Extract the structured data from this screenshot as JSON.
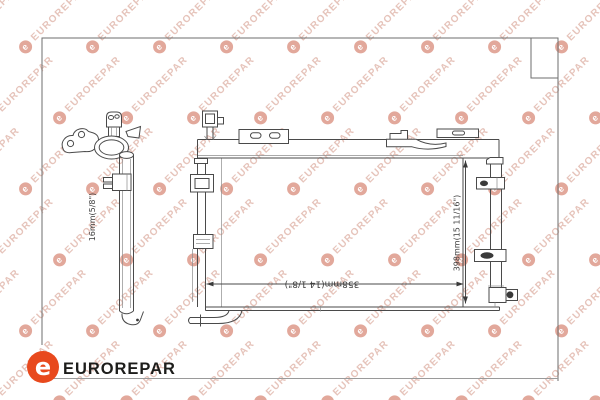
{
  "watermark": {
    "text": "EUROREPAR",
    "letter": "e",
    "text_color": "#e6c4bb",
    "circle_color": "#e2a89b",
    "letter_color": "#ffffff"
  },
  "footer": {
    "brand_text": "EUROREPAR",
    "logo_letter": "e",
    "logo_bg": "#e8491d",
    "logo_fg": "#ffffff",
    "text_color": "#1d1d1b"
  },
  "diagram": {
    "description": "A/C condenser technical line drawing, side profile view and front view",
    "line_color": "#4a4a4a",
    "dimensions": {
      "depth_label": "16mm(5/8\")",
      "width_label": "358mm(14 1/8\")",
      "height_label": "398mm(15 11/16\")"
    }
  }
}
